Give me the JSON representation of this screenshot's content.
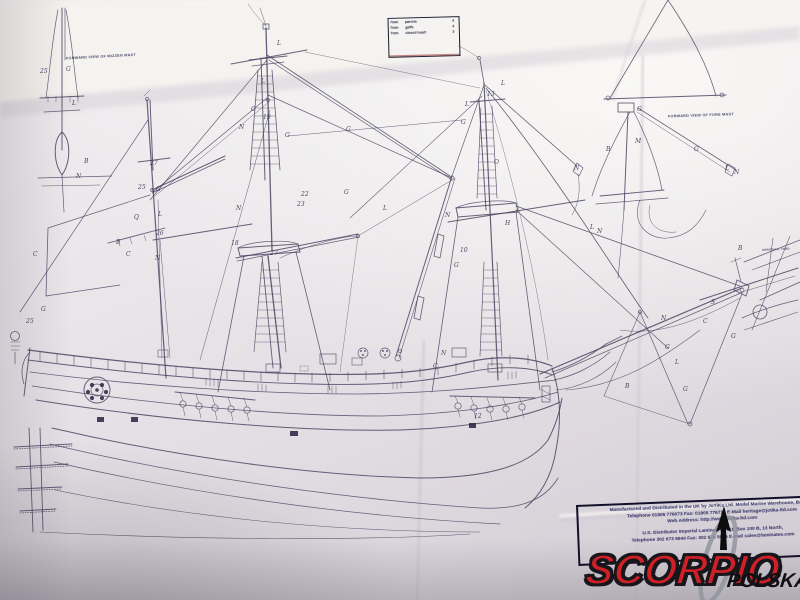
{
  "plan": {
    "titles": {
      "mizzen_view": "FORWARD VIEW OF MIZZEN MAST",
      "fore_view": "FORWARD VIEW OF FORE MAST",
      "spritsail_caption": "SPRITSAIL YARD"
    },
    "legend_table": {
      "rows": [
        {
          "size": "7mm",
          "item": "parrels",
          "qty": "4"
        },
        {
          "size": "7mm",
          "item": "gaffs",
          "qty": "4"
        },
        {
          "size": "7mm",
          "item": "closed heart",
          "qty": "3"
        }
      ]
    },
    "labels": [
      {
        "t": "25",
        "x": 40,
        "y": 68
      },
      {
        "t": "G",
        "x": 66,
        "y": 66
      },
      {
        "t": "L",
        "x": 72,
        "y": 100
      },
      {
        "t": "B",
        "x": 84,
        "y": 158
      },
      {
        "t": "N",
        "x": 76,
        "y": 173
      },
      {
        "t": "G",
        "x": 41,
        "y": 306
      },
      {
        "t": "25",
        "x": 26,
        "y": 318
      },
      {
        "t": "27",
        "x": 150,
        "y": 160
      },
      {
        "t": "25",
        "x": 138,
        "y": 184
      },
      {
        "t": "G",
        "x": 156,
        "y": 186
      },
      {
        "t": "L",
        "x": 158,
        "y": 211
      },
      {
        "t": "Q",
        "x": 134,
        "y": 214
      },
      {
        "t": "26",
        "x": 156,
        "y": 230
      },
      {
        "t": "B",
        "x": 116,
        "y": 239
      },
      {
        "t": "C",
        "x": 126,
        "y": 251
      },
      {
        "t": "N",
        "x": 155,
        "y": 255
      },
      {
        "t": "C",
        "x": 33,
        "y": 251
      },
      {
        "t": "L",
        "x": 277,
        "y": 40
      },
      {
        "t": "L",
        "x": 261,
        "y": 78
      },
      {
        "t": "G",
        "x": 251,
        "y": 106
      },
      {
        "t": "19",
        "x": 263,
        "y": 114
      },
      {
        "t": "G",
        "x": 285,
        "y": 132
      },
      {
        "t": "G",
        "x": 346,
        "y": 126
      },
      {
        "t": "N",
        "x": 239,
        "y": 124
      },
      {
        "t": "22",
        "x": 301,
        "y": 191
      },
      {
        "t": "23",
        "x": 297,
        "y": 201
      },
      {
        "t": "G",
        "x": 344,
        "y": 189
      },
      {
        "t": "N",
        "x": 236,
        "y": 205
      },
      {
        "t": "18",
        "x": 231,
        "y": 240
      },
      {
        "t": "27",
        "x": 270,
        "y": 250
      },
      {
        "t": "L",
        "x": 501,
        "y": 80
      },
      {
        "t": "13",
        "x": 487,
        "y": 91
      },
      {
        "t": "L",
        "x": 465,
        "y": 101
      },
      {
        "t": "G",
        "x": 461,
        "y": 119
      },
      {
        "t": "O",
        "x": 494,
        "y": 159
      },
      {
        "t": "N",
        "x": 574,
        "y": 165
      },
      {
        "t": "L",
        "x": 383,
        "y": 205
      },
      {
        "t": "N",
        "x": 445,
        "y": 212
      },
      {
        "t": "H",
        "x": 505,
        "y": 220
      },
      {
        "t": "10",
        "x": 460,
        "y": 247
      },
      {
        "t": "G",
        "x": 454,
        "y": 262
      },
      {
        "t": "C",
        "x": 433,
        "y": 363
      },
      {
        "t": "N",
        "x": 441,
        "y": 350
      },
      {
        "t": "12",
        "x": 474,
        "y": 413
      },
      {
        "t": "G",
        "x": 637,
        "y": 106
      },
      {
        "t": "M",
        "x": 635,
        "y": 138
      },
      {
        "t": "B",
        "x": 606,
        "y": 146
      },
      {
        "t": "G",
        "x": 694,
        "y": 146
      },
      {
        "t": "L",
        "x": 725,
        "y": 165
      },
      {
        "t": "N",
        "x": 734,
        "y": 169
      },
      {
        "t": "L",
        "x": 590,
        "y": 224
      },
      {
        "t": "N",
        "x": 597,
        "y": 228
      },
      {
        "t": "N",
        "x": 661,
        "y": 315
      },
      {
        "t": "G",
        "x": 665,
        "y": 344
      },
      {
        "t": "G",
        "x": 731,
        "y": 333
      },
      {
        "t": "C",
        "x": 703,
        "y": 318
      },
      {
        "t": "S",
        "x": 711,
        "y": 299
      },
      {
        "t": "B",
        "x": 625,
        "y": 383
      },
      {
        "t": "L",
        "x": 675,
        "y": 359
      },
      {
        "t": "G",
        "x": 683,
        "y": 386
      },
      {
        "t": "B",
        "x": 738,
        "y": 245
      }
    ]
  },
  "footer": {
    "lines": [
      "Manufactured and Distributed in the UK by JoTiKa Ltd. Model Marine Warehouse, Badsey,",
      "Telephone 01905 776073   Fax: 01905 776712   E-Mail heritage@jotika-ltd.com",
      "Web Address: http://www.jotika-ltd.com",
      "U.S. Distributor Imperial Laminates, R01, Box 100 B, 13 North,",
      "Telephone 302 673 5944   Fax: 302 678 5945   E-Mail sales@laminates.com"
    ]
  },
  "watermark": {
    "brand": "SCORPIO",
    "region": "POLSKA"
  },
  "colors": {
    "ink": "#45405e",
    "paper": "#e8e5e9",
    "brand_red": "#cf2027",
    "logo_black": "#141418",
    "swoosh_gray": "#90959d"
  }
}
